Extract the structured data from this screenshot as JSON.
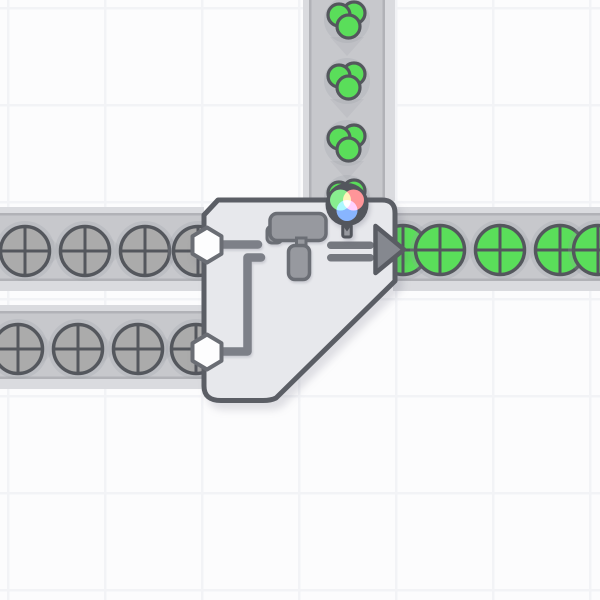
{
  "scene": {
    "type": "factory-builder-game-viewport",
    "grid_tile_px": 97
  },
  "colors": {
    "background": "#fcfcfd",
    "grid_line": "#f2f3f6",
    "belt_rail": "#dadbdf",
    "belt_band": "#c7c8cc",
    "belt_edge": "#b1b2b7",
    "belt_chevron": "#bfc0c5",
    "item_outline": "#54575d",
    "item_halo": "rgba(150,153,163,0.22)",
    "uncolored": "#ababab",
    "green": "#5ade5a",
    "building_fill": "#e7e8ec",
    "building_border": "#5b5e65",
    "icon_gray": "#97999f",
    "icon_dark": "#6b6e75",
    "arrow_fill": "#85888f",
    "arrow_outline": "#595c63",
    "arrow_tail": "#75787f",
    "pipe": "#7d8088",
    "hexagon_fill": "#fdfdfe",
    "hexagon_border": "#6a6d74",
    "wheel_blob": "#53565d",
    "wheel_red": "#ff5f5f",
    "wheel_green": "#4fe44f",
    "wheel_blue": "#4f8fff",
    "wheel_center": "#ffffff"
  },
  "building": {
    "name": "painter-double",
    "input_ports": 2,
    "output_direction": "right",
    "icons": [
      "paint-roller-icon",
      "arrow-right-icon",
      "color-wheel-icon"
    ]
  },
  "belts": [
    {
      "id": "left-top",
      "direction": "right",
      "rail": {
        "x": 0,
        "y": 207,
        "w": 204,
        "h": 84
      },
      "band": {
        "x": 0,
        "y": 213,
        "w": 204,
        "h": 68
      },
      "cross": 251,
      "chevrons": [
        55,
        115,
        175
      ],
      "items": [
        {
          "type": "circle",
          "color": "uncolored",
          "at": 25
        },
        {
          "type": "circle",
          "color": "uncolored",
          "at": 85
        },
        {
          "type": "circle",
          "color": "uncolored",
          "at": 145
        },
        {
          "type": "circle",
          "color": "uncolored",
          "at": 198
        }
      ]
    },
    {
      "id": "left-bottom",
      "direction": "right",
      "rail": {
        "x": 0,
        "y": 305,
        "w": 204,
        "h": 84
      },
      "band": {
        "x": 0,
        "y": 311,
        "w": 204,
        "h": 68
      },
      "cross": 349,
      "chevrons": [
        48,
        108,
        168
      ],
      "items": [
        {
          "type": "circle",
          "color": "uncolored",
          "at": 18
        },
        {
          "type": "circle",
          "color": "uncolored",
          "at": 78
        },
        {
          "type": "circle",
          "color": "uncolored",
          "at": 138
        },
        {
          "type": "circle",
          "color": "uncolored",
          "at": 196
        }
      ]
    },
    {
      "id": "right-output",
      "direction": "right",
      "rail": {
        "x": 393,
        "y": 207,
        "w": 207,
        "h": 84
      },
      "band": {
        "x": 393,
        "y": 213,
        "w": 207,
        "h": 68
      },
      "cross": 250,
      "chevrons": [
        470,
        530,
        590
      ],
      "items": [
        {
          "type": "circle",
          "color": "green",
          "at": 403
        },
        {
          "type": "circle",
          "color": "green",
          "at": 440
        },
        {
          "type": "circle",
          "color": "green",
          "at": 500
        },
        {
          "type": "circle",
          "color": "green",
          "at": 560
        },
        {
          "type": "circle",
          "color": "green",
          "at": 598
        }
      ]
    },
    {
      "id": "vertical-color-input",
      "direction": "down",
      "rail": {
        "x": 303,
        "y": 0,
        "w": 92,
        "h": 201
      },
      "band": {
        "x": 309,
        "y": 0,
        "w": 76,
        "h": 201
      },
      "cross": 347,
      "chevrons": [
        46,
        108,
        170
      ],
      "items": [
        {
          "type": "cluster",
          "color": "green",
          "at": 20
        },
        {
          "type": "cluster",
          "color": "green",
          "at": 81
        },
        {
          "type": "cluster",
          "color": "green",
          "at": 143
        },
        {
          "type": "cluster",
          "color": "green",
          "at": 198
        }
      ]
    }
  ]
}
